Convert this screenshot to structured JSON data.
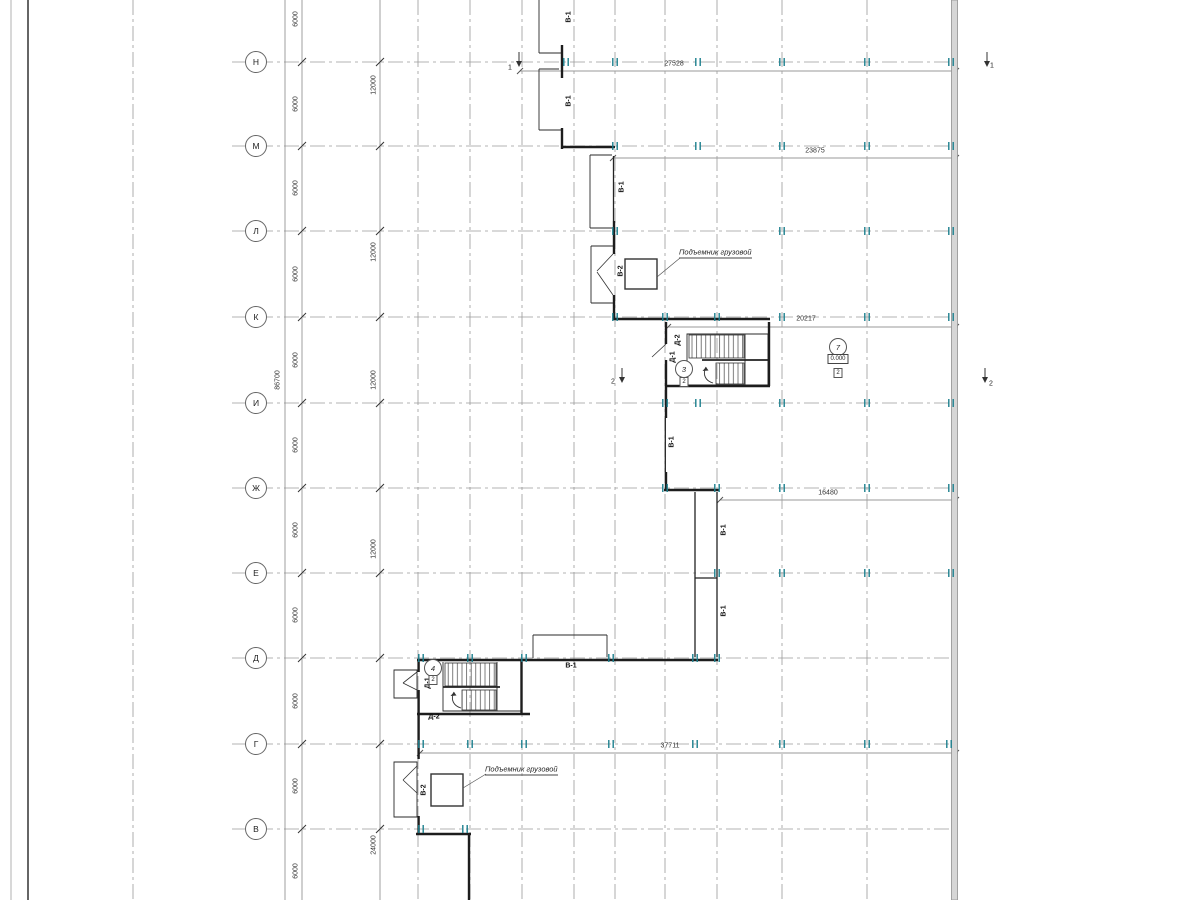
{
  "grid_rows": [
    "Н",
    "М",
    "Л",
    "К",
    "И",
    "Ж",
    "Е",
    "Д",
    "Г",
    "В"
  ],
  "dims": {
    "total": "86700",
    "bay": "6000",
    "double_bay": "12000",
    "bottom": "24000",
    "row_n": "27528",
    "row_m": "23875",
    "row_k": "20217",
    "row_zh": "16480",
    "row_g": "37711"
  },
  "marks": {
    "v1": "В-1",
    "v2": "В-2",
    "d1": "Д-1",
    "d2": "Д-2",
    "hoist_note": "Подъемник грузовой",
    "elevation": "0.000",
    "section_1": "1",
    "section_2": "2",
    "room_7": "7",
    "room_3": "3",
    "room_4": "4",
    "floor_box": "2"
  }
}
